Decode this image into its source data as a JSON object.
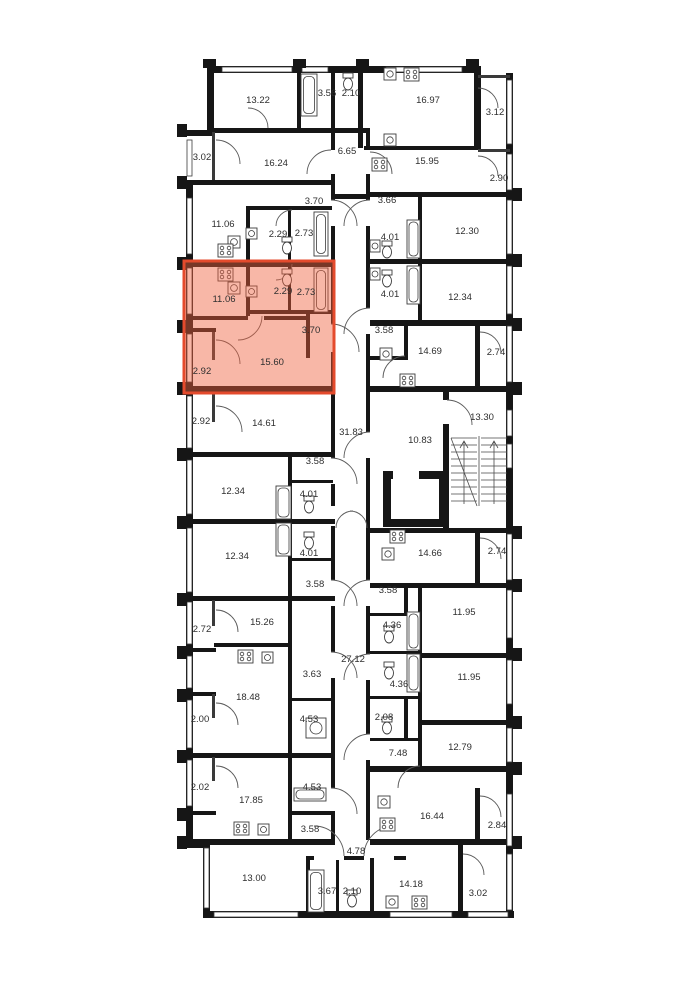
{
  "plan": {
    "title": "floor-plan",
    "highlight": {
      "fill": "rgba(240,95,60,0.45)",
      "stroke": "#e44b2d",
      "selected_area_label": "15.60"
    },
    "rooms": [
      {
        "label": "13.22",
        "x": 258,
        "y": 100,
        "hl": false
      },
      {
        "label": "3.56",
        "x": 327,
        "y": 93,
        "hl": false
      },
      {
        "label": "2.10",
        "x": 351,
        "y": 93,
        "hl": false
      },
      {
        "label": "16.97",
        "x": 428,
        "y": 100,
        "hl": false
      },
      {
        "label": "3.12",
        "x": 495,
        "y": 112,
        "hl": false
      },
      {
        "label": "3.02",
        "x": 202,
        "y": 157,
        "hl": false
      },
      {
        "label": "16.24",
        "x": 276,
        "y": 163,
        "hl": false
      },
      {
        "label": "6.65",
        "x": 347,
        "y": 151,
        "hl": false
      },
      {
        "label": "15.95",
        "x": 427,
        "y": 161,
        "hl": false
      },
      {
        "label": "2.90",
        "x": 499,
        "y": 178,
        "hl": false
      },
      {
        "label": "3.70",
        "x": 314,
        "y": 201,
        "hl": false
      },
      {
        "label": "3.66",
        "x": 387,
        "y": 200,
        "hl": false
      },
      {
        "label": "11.06",
        "x": 223,
        "y": 224,
        "hl": false
      },
      {
        "label": "2.29",
        "x": 278,
        "y": 234,
        "hl": false
      },
      {
        "label": "2.73",
        "x": 304,
        "y": 233,
        "hl": false
      },
      {
        "label": "4.01",
        "x": 390,
        "y": 237,
        "hl": false
      },
      {
        "label": "12.30",
        "x": 467,
        "y": 231,
        "hl": false
      },
      {
        "label": "11.06",
        "x": 224,
        "y": 299,
        "hl": true
      },
      {
        "label": "2.29",
        "x": 283,
        "y": 291,
        "hl": true
      },
      {
        "label": "2.73",
        "x": 306,
        "y": 292,
        "hl": true
      },
      {
        "label": "4.01",
        "x": 390,
        "y": 294,
        "hl": false
      },
      {
        "label": "12.34",
        "x": 460,
        "y": 297,
        "hl": false
      },
      {
        "label": "3.70",
        "x": 311,
        "y": 330,
        "hl": true
      },
      {
        "label": "3.58",
        "x": 384,
        "y": 330,
        "hl": false
      },
      {
        "label": "15.60",
        "x": 272,
        "y": 362,
        "hl": true
      },
      {
        "label": "14.69",
        "x": 430,
        "y": 351,
        "hl": false
      },
      {
        "label": "2.74",
        "x": 496,
        "y": 352,
        "hl": false
      },
      {
        "label": "2.92",
        "x": 202,
        "y": 371,
        "hl": true
      },
      {
        "label": "2.92",
        "x": 201,
        "y": 421,
        "hl": false
      },
      {
        "label": "14.61",
        "x": 264,
        "y": 423,
        "hl": false
      },
      {
        "label": "31.83",
        "x": 351,
        "y": 432,
        "hl": false
      },
      {
        "label": "10.83",
        "x": 420,
        "y": 440,
        "hl": false
      },
      {
        "label": "13.30",
        "x": 482,
        "y": 417,
        "hl": false
      },
      {
        "label": "3.58",
        "x": 315,
        "y": 461,
        "hl": false
      },
      {
        "label": "12.34",
        "x": 233,
        "y": 491,
        "hl": false
      },
      {
        "label": "4.01",
        "x": 309,
        "y": 494,
        "hl": false
      },
      {
        "label": "12.34",
        "x": 237,
        "y": 556,
        "hl": false
      },
      {
        "label": "4.01",
        "x": 309,
        "y": 553,
        "hl": false
      },
      {
        "label": "14.66",
        "x": 430,
        "y": 553,
        "hl": false
      },
      {
        "label": "2.74",
        "x": 497,
        "y": 551,
        "hl": false
      },
      {
        "label": "3.58",
        "x": 315,
        "y": 584,
        "hl": false
      },
      {
        "label": "3.58",
        "x": 388,
        "y": 590,
        "hl": false
      },
      {
        "label": "11.95",
        "x": 464,
        "y": 612,
        "hl": false
      },
      {
        "label": "2.72",
        "x": 202,
        "y": 629,
        "hl": false
      },
      {
        "label": "15.26",
        "x": 262,
        "y": 622,
        "hl": false
      },
      {
        "label": "4.36",
        "x": 392,
        "y": 625,
        "hl": false
      },
      {
        "label": "27.12",
        "x": 353,
        "y": 659,
        "hl": false
      },
      {
        "label": "4.36",
        "x": 399,
        "y": 684,
        "hl": false
      },
      {
        "label": "11.95",
        "x": 469,
        "y": 677,
        "hl": false
      },
      {
        "label": "18.48",
        "x": 248,
        "y": 697,
        "hl": false
      },
      {
        "label": "3.63",
        "x": 312,
        "y": 674,
        "hl": false
      },
      {
        "label": "2.00",
        "x": 200,
        "y": 719,
        "hl": false
      },
      {
        "label": "4.53",
        "x": 309,
        "y": 719,
        "hl": false
      },
      {
        "label": "2.08",
        "x": 384,
        "y": 717,
        "hl": false
      },
      {
        "label": "7.48",
        "x": 398,
        "y": 753,
        "hl": false
      },
      {
        "label": "12.79",
        "x": 460,
        "y": 747,
        "hl": false
      },
      {
        "label": "2.02",
        "x": 200,
        "y": 787,
        "hl": false
      },
      {
        "label": "17.85",
        "x": 251,
        "y": 800,
        "hl": false
      },
      {
        "label": "4.53",
        "x": 312,
        "y": 787,
        "hl": false
      },
      {
        "label": "3.58",
        "x": 310,
        "y": 829,
        "hl": false
      },
      {
        "label": "16.44",
        "x": 432,
        "y": 816,
        "hl": false
      },
      {
        "label": "2.84",
        "x": 497,
        "y": 825,
        "hl": false
      },
      {
        "label": "4.78",
        "x": 356,
        "y": 851,
        "hl": false
      },
      {
        "label": "13.00",
        "x": 254,
        "y": 878,
        "hl": false
      },
      {
        "label": "3.67",
        "x": 327,
        "y": 891,
        "hl": false
      },
      {
        "label": "2.10",
        "x": 352,
        "y": 891,
        "hl": false
      },
      {
        "label": "14.18",
        "x": 411,
        "y": 884,
        "hl": false
      },
      {
        "label": "3.02",
        "x": 478,
        "y": 893,
        "hl": false
      }
    ]
  }
}
